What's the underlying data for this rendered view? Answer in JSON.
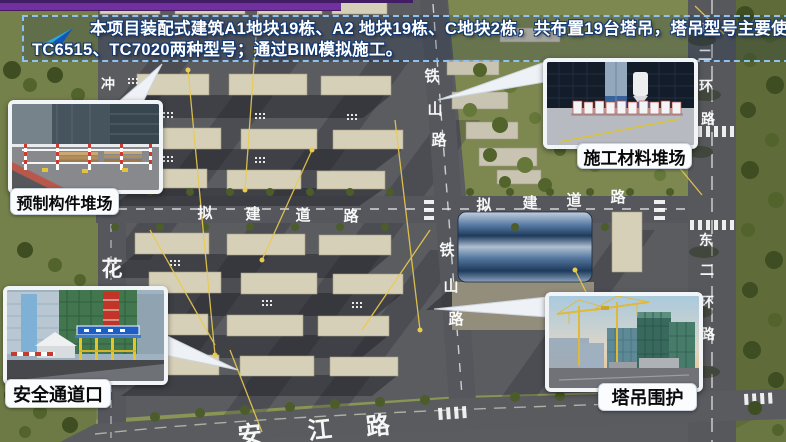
{
  "banner": {
    "line1": "本项目装配式建筑A1地块19栋、A2 地块19栋、C地块2栋，共布置19台塔吊，塔吊型号主要使用",
    "line2": "TC6515、TC7020两种型号；通过BIM模拟施工。",
    "icon": "paper-plane-arrow-icon",
    "border_color": "#8fc2f2",
    "text_color": "#ffffff",
    "outline_color": "#143a74"
  },
  "decor": {
    "top_bar_color": "#7030a0",
    "top_line_color": "#431c66"
  },
  "callouts": [
    {
      "id": "precast-yard",
      "label": "预制构件堆场"
    },
    {
      "id": "material-yard",
      "label": "施工材料堆场"
    },
    {
      "id": "safety-entrance",
      "label": "安全通道口"
    },
    {
      "id": "crane-enclosure",
      "label": "塔吊围护"
    }
  ],
  "map": {
    "road_labels": {
      "tieshan_top": [
        "铁",
        "山",
        "路"
      ],
      "tieshan_bottom": [
        "铁",
        "山",
        "路"
      ],
      "nijian_west": [
        "拟",
        "建",
        "道",
        "路"
      ],
      "nijian_east": [
        "拟",
        "建",
        "道",
        "路"
      ],
      "hua": [
        "花"
      ],
      "chong": [
        "冲"
      ],
      "donghuan_north": [
        "东",
        "二",
        "环",
        "路"
      ],
      "donghuan_south": [
        "东",
        "二",
        "环",
        "路"
      ],
      "anjiang": [
        "安",
        "江",
        "路"
      ]
    },
    "colors": {
      "site_ground": "#5a5c60",
      "road": "#55575c",
      "green": "#7d8851",
      "building": "#d7d0b8",
      "warehouse_roof": "#2e4a6c",
      "crane_line": "#e9cb4e"
    }
  }
}
